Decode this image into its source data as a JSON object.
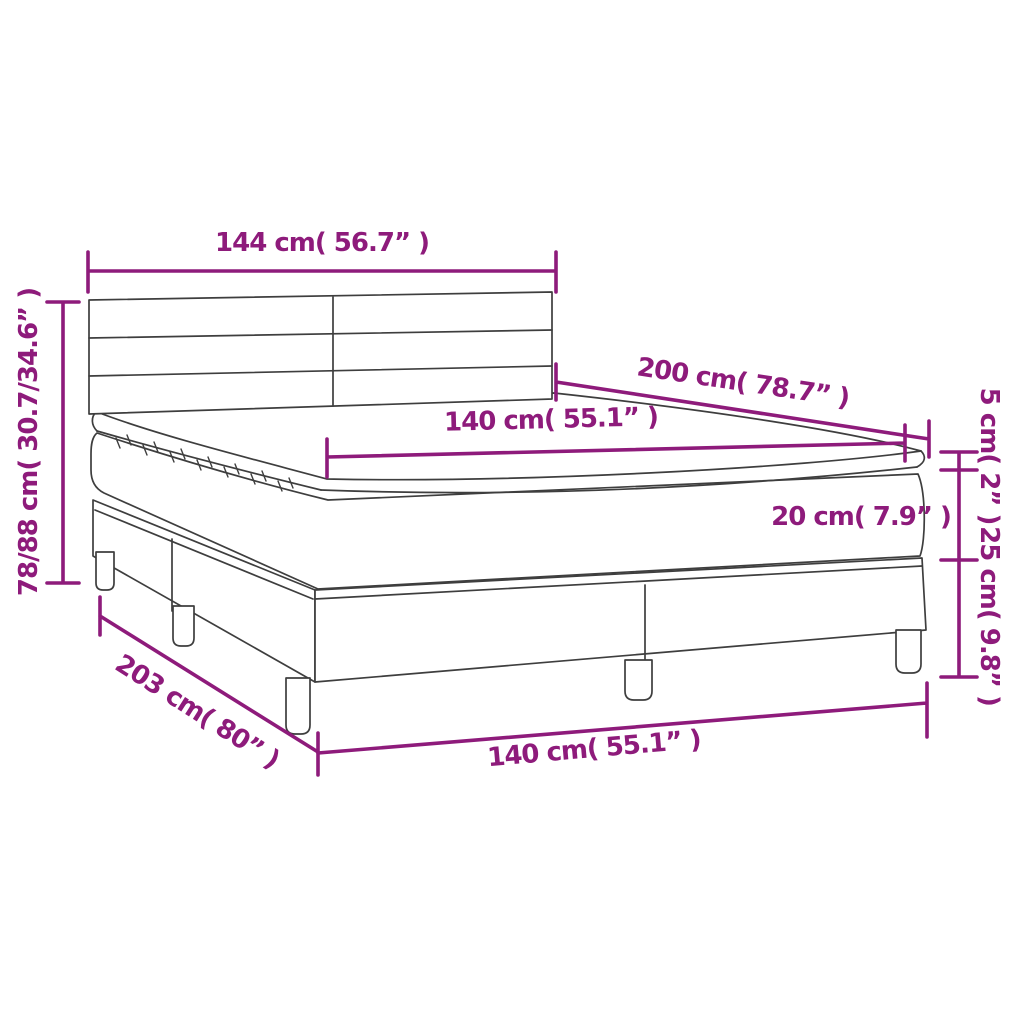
{
  "diagram": {
    "subject": "Box spring bed with headboard, topper and mattress - dimension diagram",
    "style": {
      "accent_color": "#8E1B7B",
      "line_art_color": "#3E3E3E",
      "background": "#FFFFFF"
    },
    "labels": {
      "headboard_width": "144 cm( 56.7” )",
      "bed_height_range": "78/88 cm( 30.7/34.6” )",
      "sleeping_length": "200 cm( 78.7” )",
      "sleeping_width_top": "140 cm( 55.1” )",
      "topper_thickness": "5 cm( 2” )",
      "mattress_thickness": "20 cm( 7.9” )",
      "base_height": "25 cm( 9.8” )",
      "total_length": "203 cm( 80” )",
      "sleeping_width_bottom": "140 cm( 55.1” )"
    }
  }
}
